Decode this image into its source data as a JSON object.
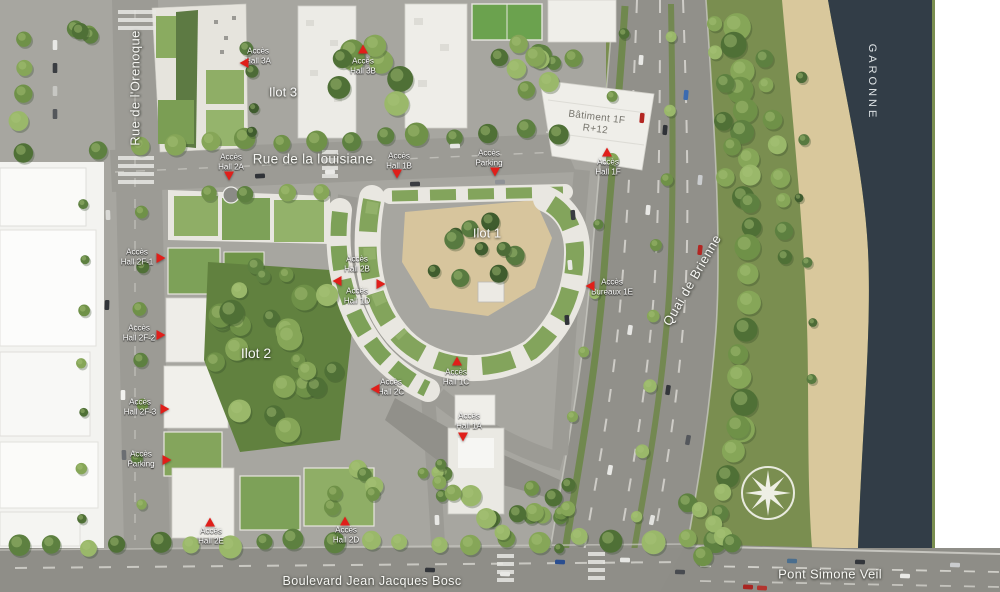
{
  "title": "Aerial masterplan site map",
  "map": {
    "streets": {
      "orenoque": "Rue de l'Orenoque",
      "louisiane": "Rue de la louisiane",
      "quai_de_brienne": "Quai de Brienne",
      "boulevard": "Boulevard Jean Jacques Bosc"
    },
    "landmarks": {
      "garonne": "GARONNE",
      "pont": "Pont Simone Veil"
    },
    "blocks": {
      "ilot1": "Ilot 1",
      "ilot2": "Ilot 2",
      "ilot3": "Ilot 3"
    },
    "building": {
      "line1": "Bâtiment 1F",
      "line2": "R+12"
    },
    "access_points": [
      {
        "id": "hall-3a",
        "lines": [
          "Accès",
          "Hall 3A"
        ],
        "x": 258,
        "y": 56,
        "tri": {
          "x": 244,
          "y": 63,
          "dir": "left"
        }
      },
      {
        "id": "hall-3b",
        "lines": [
          "Accès",
          "Hall 3B"
        ],
        "x": 363,
        "y": 66,
        "tri": {
          "x": 363,
          "y": 49,
          "dir": "up"
        }
      },
      {
        "id": "hall-2a",
        "lines": [
          "Accès",
          "Hall 2A"
        ],
        "x": 231,
        "y": 162,
        "tri": {
          "x": 229,
          "y": 176,
          "dir": "down"
        }
      },
      {
        "id": "hall-1b",
        "lines": [
          "Accès",
          "Hall 1B"
        ],
        "x": 399,
        "y": 161,
        "tri": {
          "x": 397,
          "y": 174,
          "dir": "down"
        }
      },
      {
        "id": "parking-nord",
        "lines": [
          "Accès",
          "Parking"
        ],
        "x": 489,
        "y": 158,
        "tri": {
          "x": 495,
          "y": 172,
          "dir": "down"
        }
      },
      {
        "id": "hall-1f",
        "lines": [
          "Accès",
          "Hall 1F"
        ],
        "x": 608,
        "y": 167,
        "tri": {
          "x": 607,
          "y": 152,
          "dir": "up"
        }
      },
      {
        "id": "hall-2f-1",
        "lines": [
          "Accès",
          "Hall 2F-1"
        ],
        "x": 137,
        "y": 257,
        "tri": {
          "x": 161,
          "y": 258,
          "dir": "right"
        }
      },
      {
        "id": "hall-2b",
        "lines": [
          "Accès",
          "Hall 2B"
        ],
        "x": 357,
        "y": 264,
        "tri": {
          "x": 337,
          "y": 281,
          "dir": "left"
        }
      },
      {
        "id": "hall-1d",
        "lines": [
          "Accès",
          "Hall 1D"
        ],
        "x": 357,
        "y": 296,
        "tri": {
          "x": 381,
          "y": 284,
          "dir": "right"
        }
      },
      {
        "id": "hall-2f-2",
        "lines": [
          "Accès",
          "Hall 2F-2"
        ],
        "x": 139,
        "y": 333,
        "tri": {
          "x": 161,
          "y": 335,
          "dir": "right"
        }
      },
      {
        "id": "hall-2c",
        "lines": [
          "Accès",
          "Hall 2C"
        ],
        "x": 391,
        "y": 387,
        "tri": {
          "x": 375,
          "y": 389,
          "dir": "left"
        }
      },
      {
        "id": "bureaux-1e",
        "lines": [
          "Accès",
          "Bureaux 1E"
        ],
        "x": 612,
        "y": 287,
        "tri": {
          "x": 590,
          "y": 286,
          "dir": "left"
        }
      },
      {
        "id": "hall-2f-3",
        "lines": [
          "Accès",
          "Hall 2F-3"
        ],
        "x": 140,
        "y": 407,
        "tri": {
          "x": 165,
          "y": 409,
          "dir": "right"
        }
      },
      {
        "id": "parking-ouest",
        "lines": [
          "Accès",
          "Parking"
        ],
        "x": 141,
        "y": 459,
        "tri": {
          "x": 167,
          "y": 460,
          "dir": "right"
        }
      },
      {
        "id": "hall-1c",
        "lines": [
          "Accès",
          "Hall 1C"
        ],
        "x": 456,
        "y": 377,
        "tri": {
          "x": 457,
          "y": 361,
          "dir": "up"
        }
      },
      {
        "id": "hall-1a",
        "lines": [
          "Accès",
          "Hall 1A"
        ],
        "x": 469,
        "y": 421,
        "tri": {
          "x": 463,
          "y": 437,
          "dir": "down"
        }
      },
      {
        "id": "hall-2e",
        "lines": [
          "Accès",
          "Hall 2E"
        ],
        "x": 211,
        "y": 536,
        "tri": {
          "x": 210,
          "y": 522,
          "dir": "up"
        }
      },
      {
        "id": "hall-2d",
        "lines": [
          "Accès",
          "Hall 2D"
        ],
        "x": 346,
        "y": 535,
        "tri": {
          "x": 345,
          "y": 521,
          "dir": "up"
        }
      }
    ],
    "colors": {
      "accent_red": "#e01f1a",
      "water": "#323d47",
      "sand": "#d9c89c",
      "roof_green": "#83a45c",
      "park_green": "#7a8e50"
    },
    "compass": {
      "x": 768,
      "y": 493
    }
  }
}
